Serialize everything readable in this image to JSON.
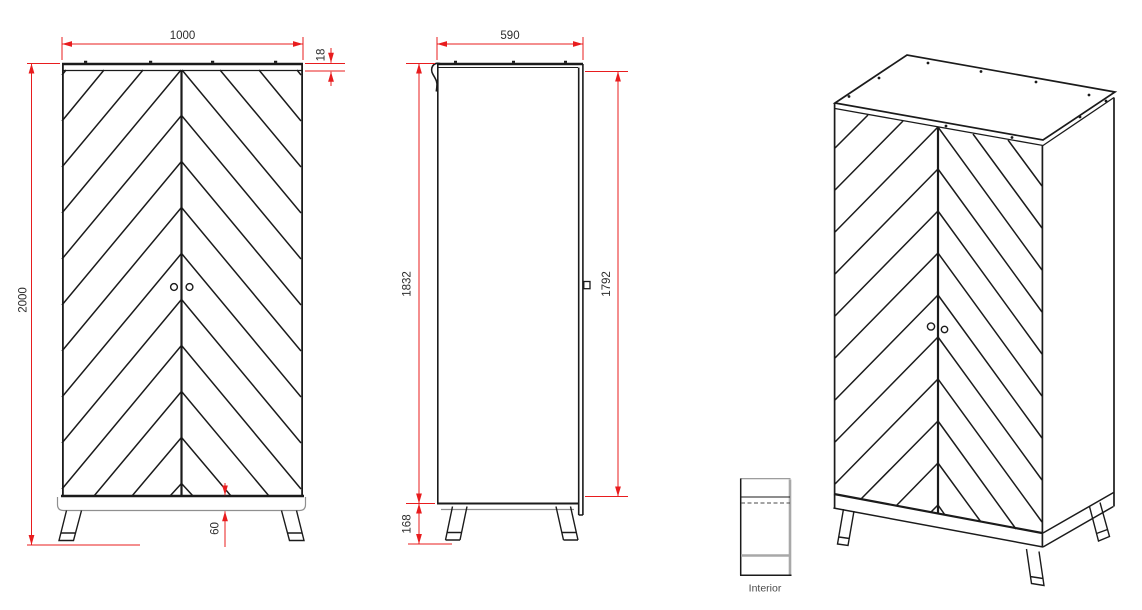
{
  "dimensions": {
    "front_width": "1000",
    "top_panel_thickness": "18",
    "overall_height": "2000",
    "plinth_height": "60",
    "depth": "590",
    "carcass_height": "1832",
    "door_height": "1792",
    "leg_height": "168"
  },
  "interior_label": "Interior",
  "colors": {
    "dimension_red": "#e81c1e",
    "line_black": "#1b1b1b",
    "detail_gray": "#a8a8a8",
    "text_dark": "#2d2d2d"
  }
}
